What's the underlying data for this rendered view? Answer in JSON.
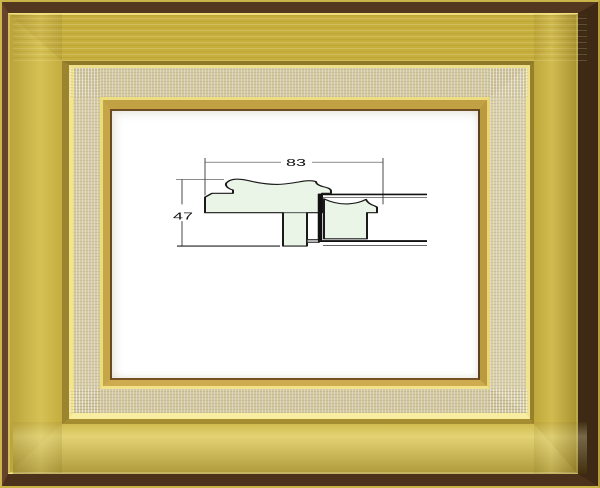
{
  "diagram": {
    "width_label": "83",
    "height_label": "47",
    "profile_fill": "#eaf5e7",
    "outline_color": "#1a1a1a",
    "dimension_line_color": "#4a4a4a"
  },
  "frame": {
    "gold_band": "#d0ba46",
    "brown_edge": "#54371f",
    "linen_liner": "#d4caa4",
    "gilt_highlight": "#f1e58e"
  }
}
